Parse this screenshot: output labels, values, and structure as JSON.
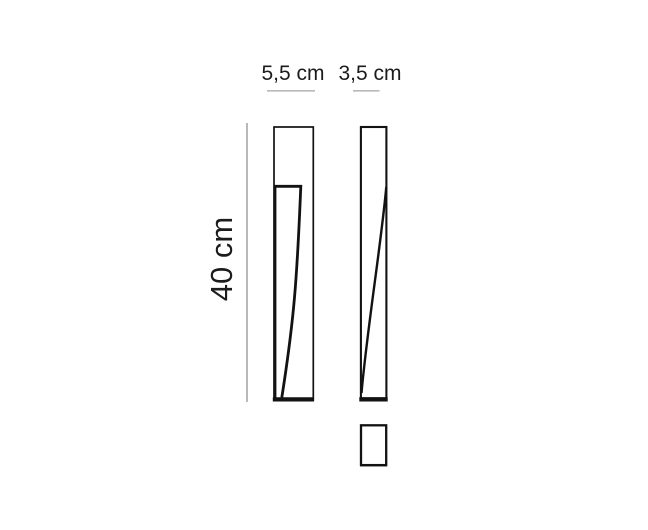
{
  "diagram": {
    "labels": {
      "front_width": "5,5 cm",
      "side_depth": "3,5 cm",
      "height": "40 cm"
    },
    "values": {
      "front_width_cm": 5.5,
      "side_depth_cm": 3.5,
      "height_cm": 40,
      "unit": "cm"
    },
    "colors": {
      "line": "#121212",
      "dimension_line": "#b9b9b9",
      "text": "#1c1c1c",
      "background": "#ffffff"
    }
  }
}
